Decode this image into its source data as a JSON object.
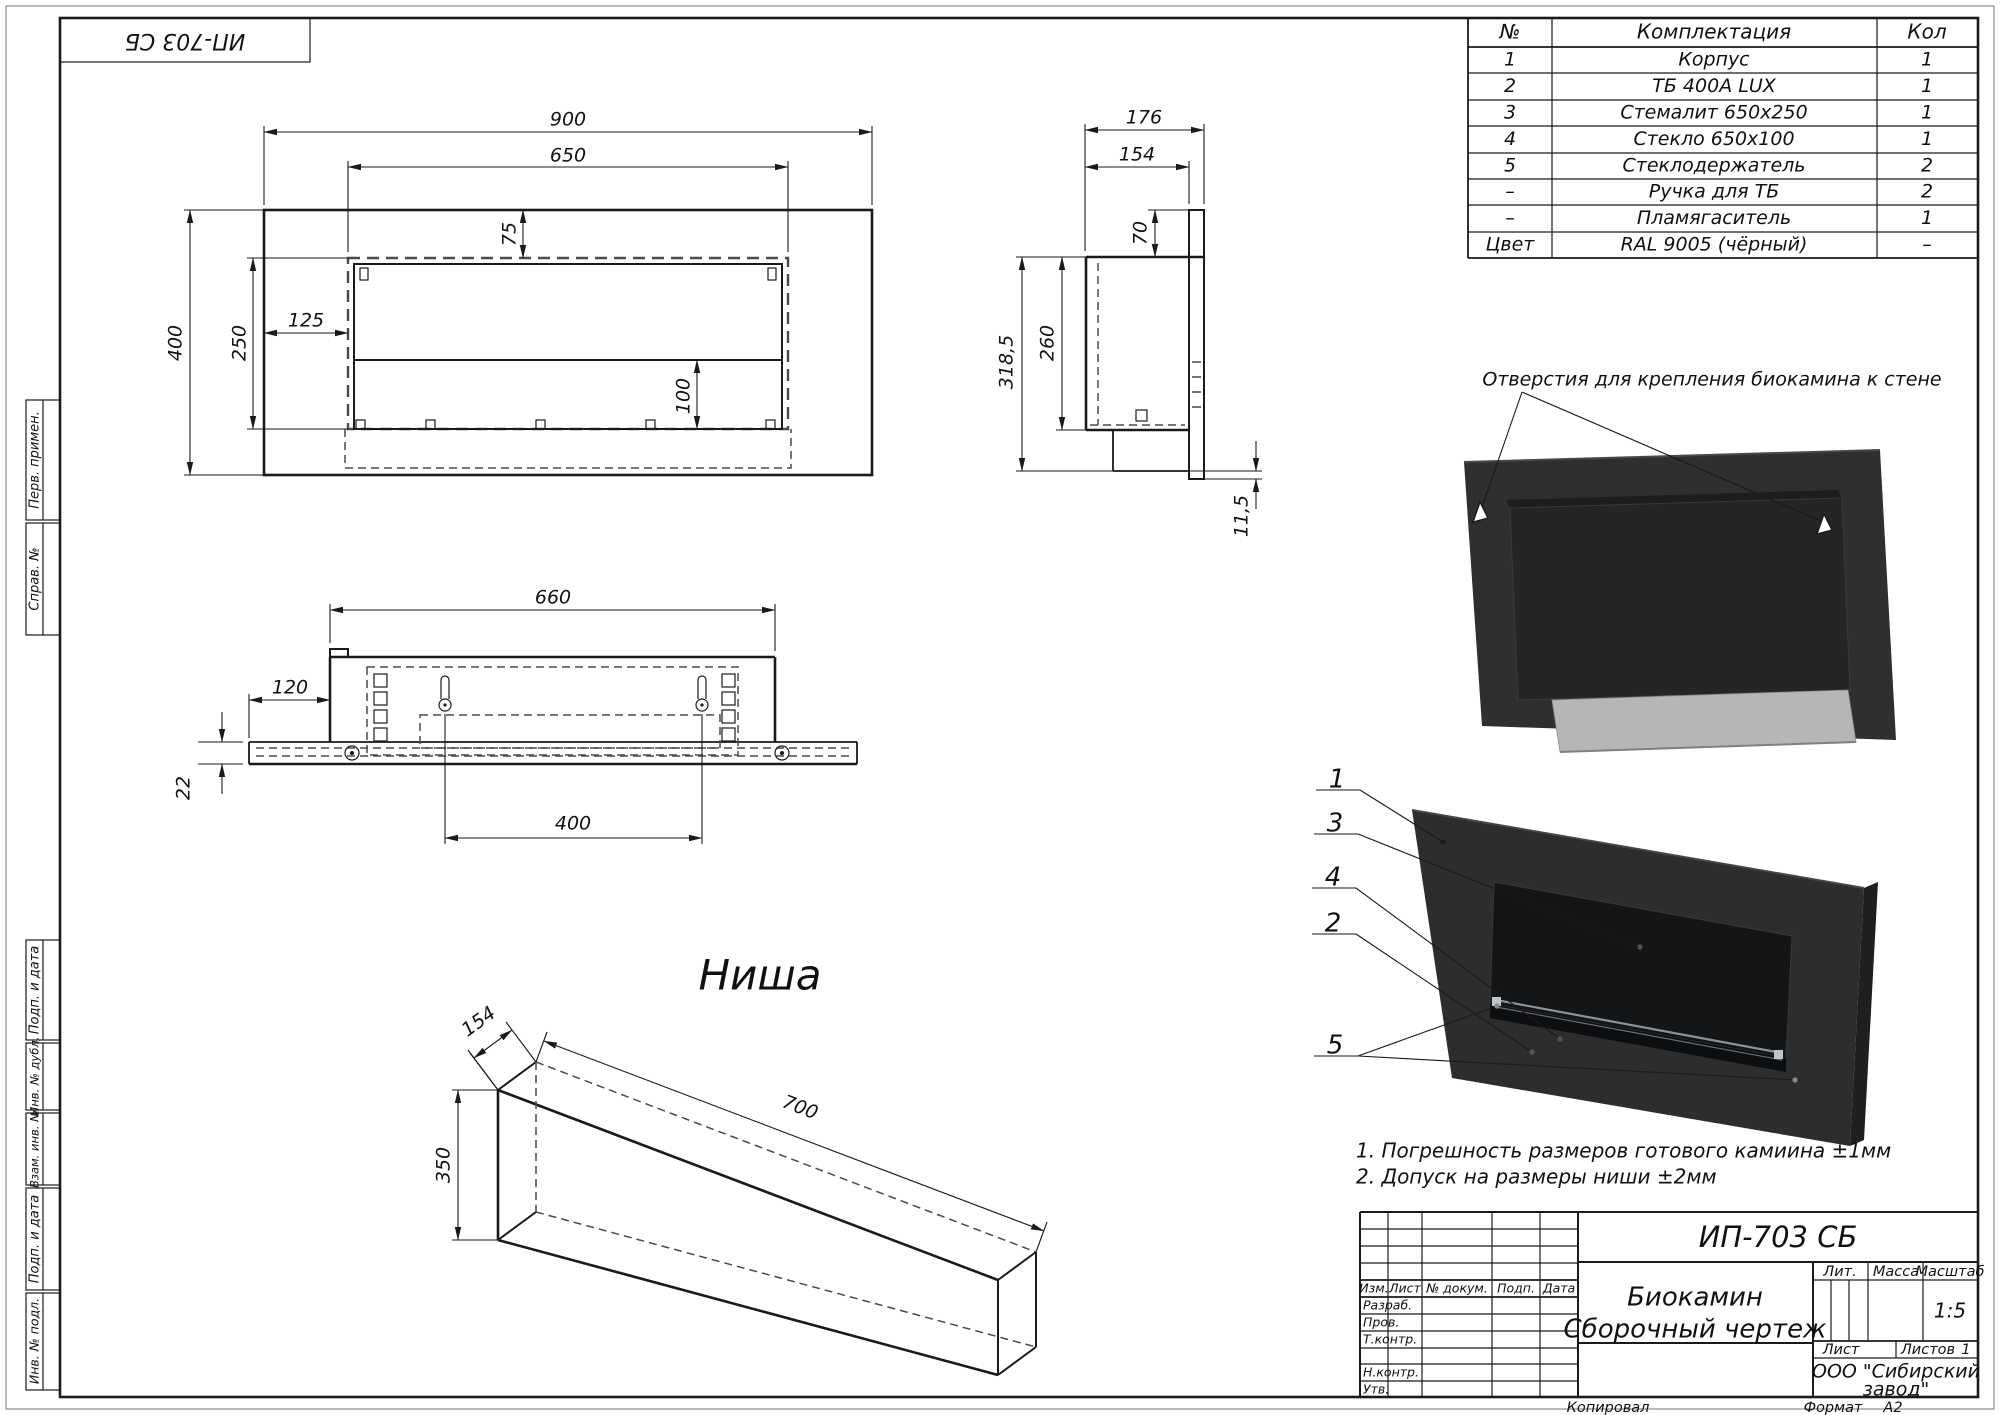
{
  "sheet": {
    "stamp_top_left": "ИП-703 СБ",
    "copied": "Копировал",
    "format_label": "Формат",
    "format_value": "А2"
  },
  "margin": {
    "perv_primen": "Перв. примен.",
    "sprav_no": "Справ. №",
    "podp_i_data_1": "Подп. и дата",
    "inv_no_dubl": "Инв. № дубл.",
    "vzam_inv_no": "Взам. инв. №",
    "podp_i_data_2": "Подп. и дата",
    "inv_no_podl": "Инв. № подл."
  },
  "parts_table": {
    "headers": {
      "no": "№",
      "name": "Комплектация",
      "qty": "Кол"
    },
    "rows": [
      {
        "no": "1",
        "name": "Корпус",
        "qty": "1"
      },
      {
        "no": "2",
        "name": "ТБ 400А LUX",
        "qty": "1"
      },
      {
        "no": "3",
        "name": "Стемалит 650х250",
        "qty": "1"
      },
      {
        "no": "4",
        "name": "Стекло 650х100",
        "qty": "1"
      },
      {
        "no": "5",
        "name": "Стеклодержатель",
        "qty": "2"
      },
      {
        "no": "–",
        "name": "Ручка для ТБ",
        "qty": "2"
      },
      {
        "no": "–",
        "name": "Пламягаситель",
        "qty": "1"
      },
      {
        "no": "Цвет",
        "name": "RAL 9005 (чёрный)",
        "qty": "–"
      }
    ]
  },
  "front_view": {
    "dim_width": "900",
    "dim_opening_width": "650",
    "dim_top_offset": "75",
    "dim_left_offset": "125",
    "dim_opening_height": "250",
    "dim_height": "400",
    "dim_inner_height": "100"
  },
  "side_view": {
    "dim_depth": "176",
    "dim_inner_depth": "154",
    "dim_top": "70",
    "dim_body_height": "260",
    "dim_total_height": "318,5",
    "dim_wall_gap": "11,5"
  },
  "top_view": {
    "dim_width": "660",
    "dim_side_offset": "120",
    "dim_plate_thickness": "22",
    "dim_mount_spacing": "400"
  },
  "niche_view": {
    "title": "Ниша",
    "dim_depth": "154",
    "dim_length": "700",
    "dim_height": "350"
  },
  "annotations": {
    "mounting_holes_label": "Отверстия для крепления биокамина к стене",
    "note_1": "1. Погрешность размеров готового камиина ±1мм",
    "note_2": "2. Допуск на размеры ниши ±2мм",
    "callouts": [
      "1",
      "3",
      "4",
      "2",
      "5"
    ]
  },
  "title_block": {
    "doc_number": "ИП-703 СБ",
    "product_name": "Биокамин",
    "doc_type": "Сборочный чертеж",
    "company_line_1": "ООО \"Сибирский",
    "company_line_2": "завод\"",
    "scale_value": "1:5",
    "sheets_value": "1",
    "labels": {
      "izm": "Изм.",
      "list": "Лист",
      "n_dokum": "№ докум.",
      "podp": "Подп.",
      "data": "Дата",
      "razrab": "Разраб.",
      "prov": "Пров.",
      "t_kontr": "Т.контр.",
      "n_kontr": "Н.контр.",
      "utv": "Утв.",
      "lit": "Лит.",
      "massa": "Масса",
      "masshtab": "Масштаб",
      "list2": "Лист",
      "listov": "Листов"
    }
  },
  "colors": {
    "line": "#1a1a1a",
    "dashed": "#4a4a4a",
    "fireplace_dark": "#2c2d2f",
    "fireplace_inner": "#141517",
    "shelf_gray": "#b4b6b8"
  }
}
